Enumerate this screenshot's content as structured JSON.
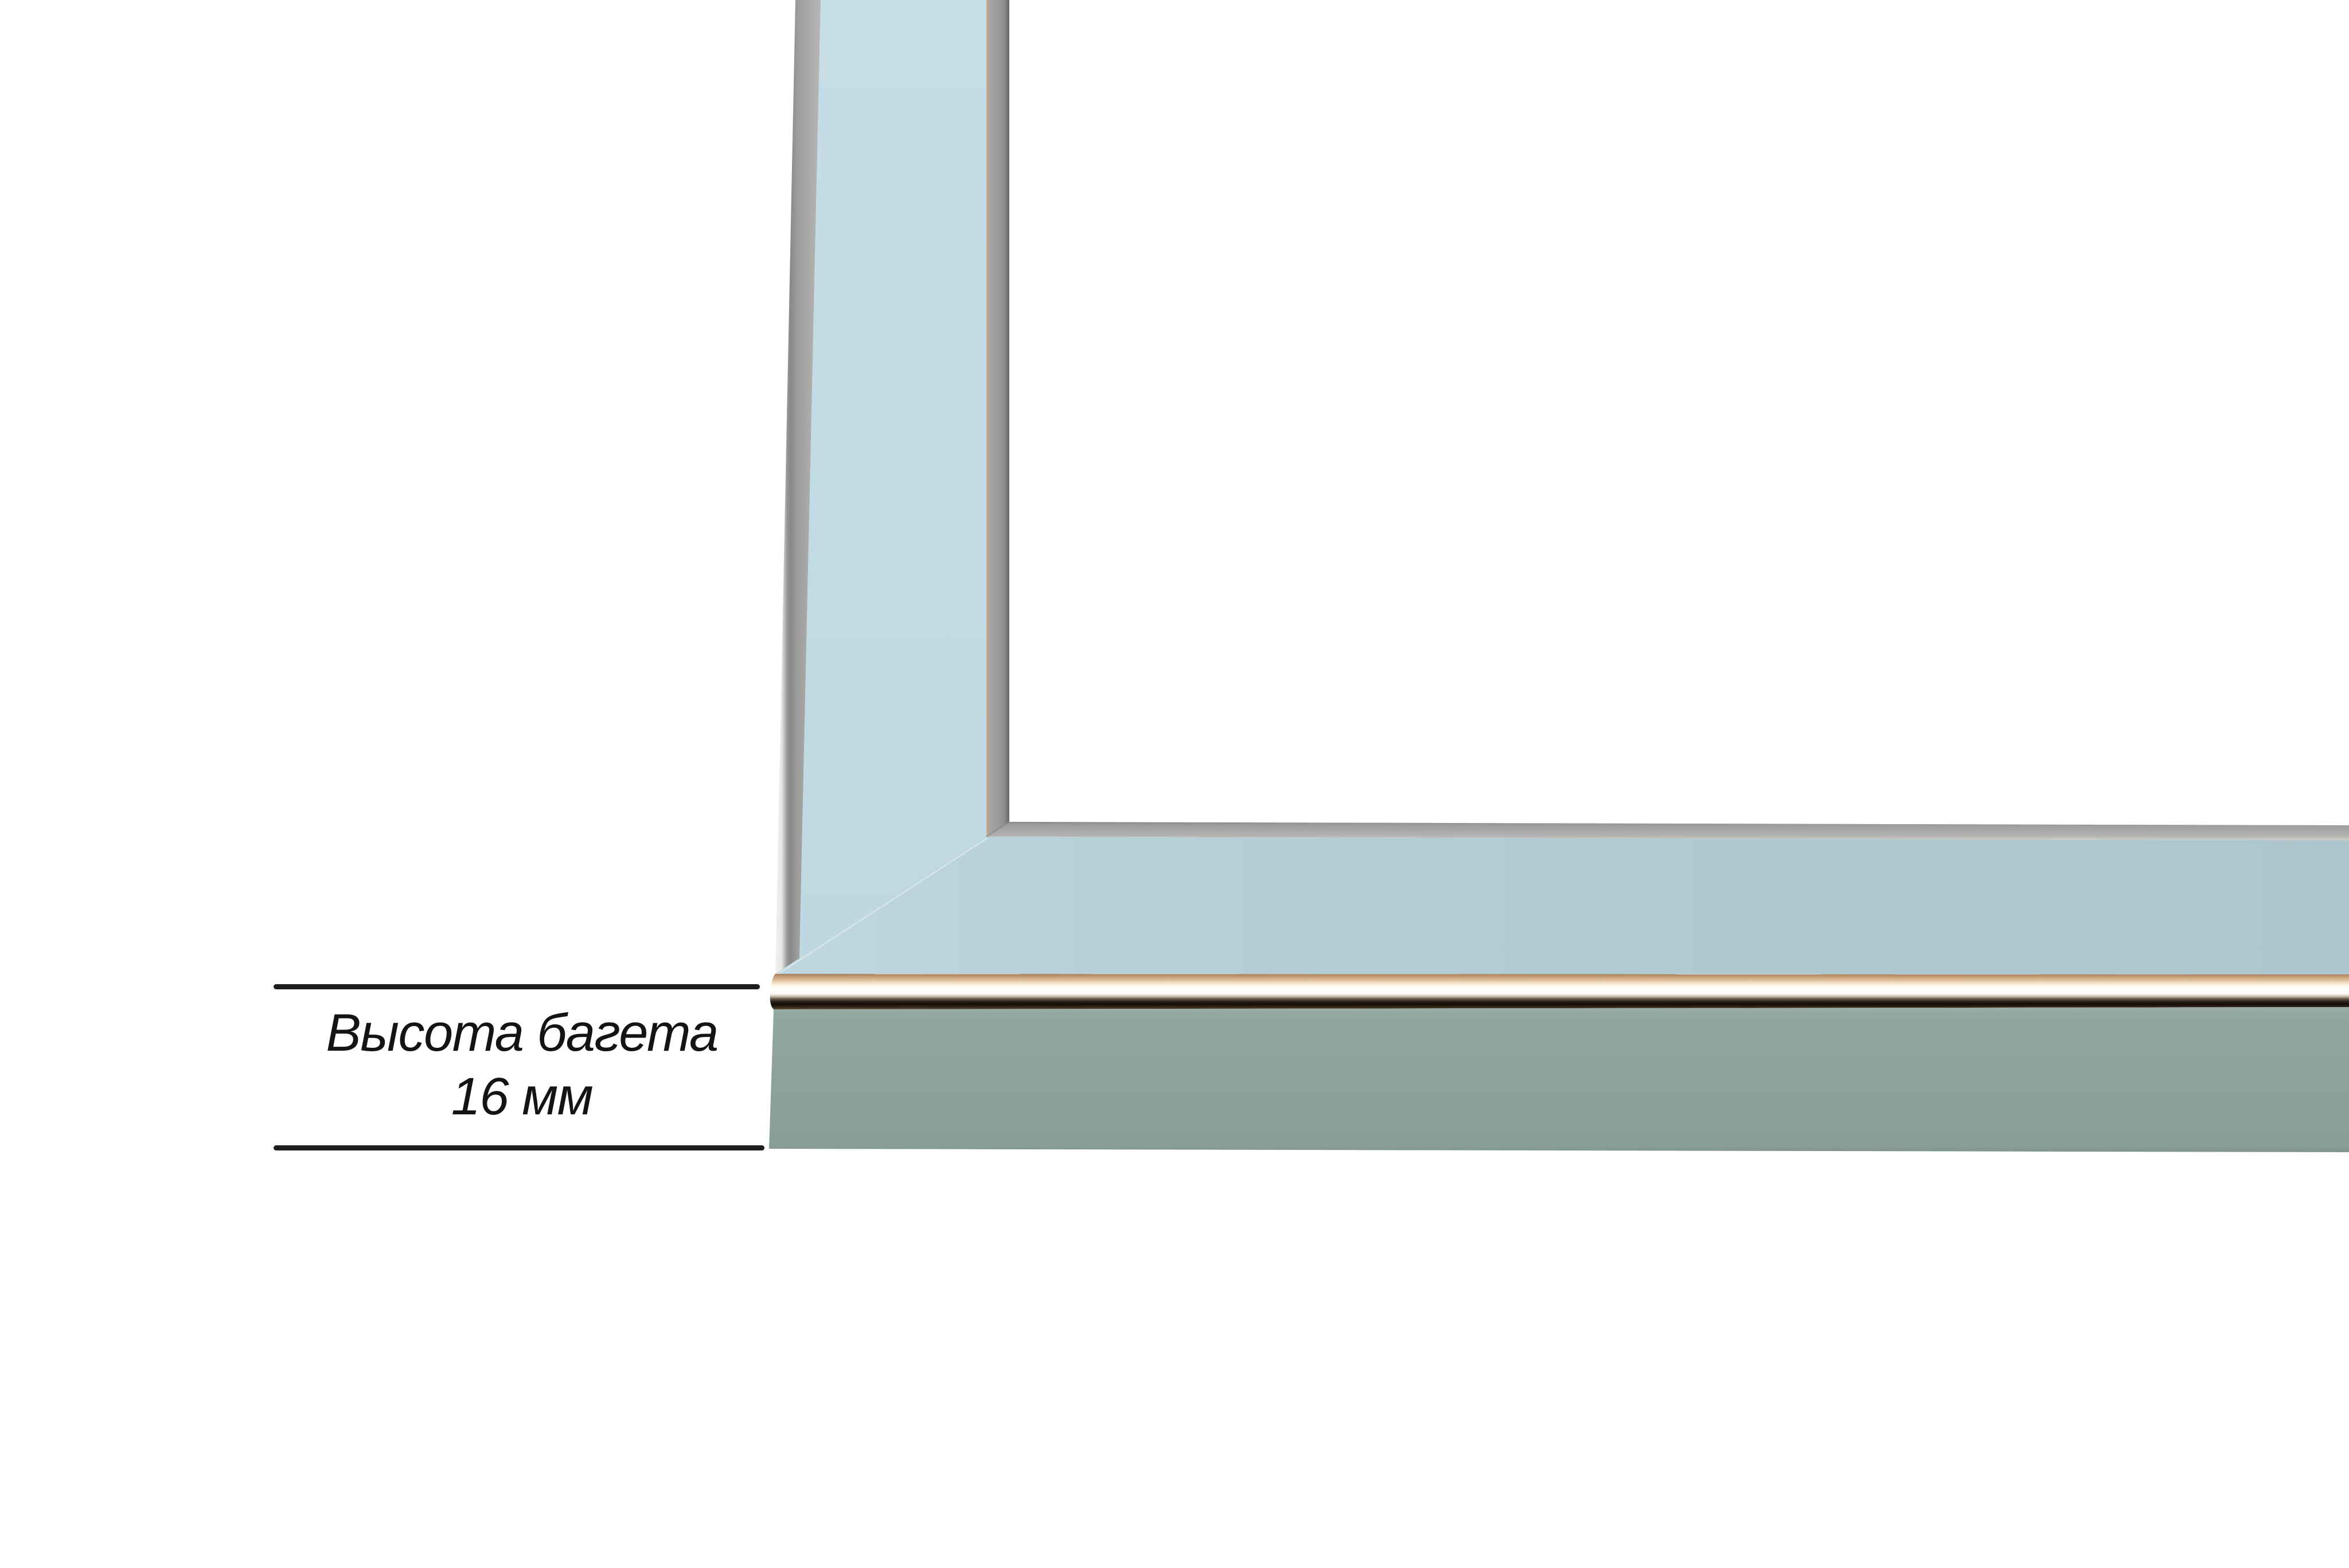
{
  "photo": {
    "kind": "frame-moulding-corner-product-photo",
    "background_color": "#ffffff"
  },
  "annotation": {
    "title_line": "Высота багета",
    "value_line": "16 мм",
    "text_color": "#141414",
    "line_color": "#1d1d1b"
  },
  "frame_colors": {
    "top_face_vertical_bar": "#c3dbe4",
    "top_face_horizontal_bar": "#b2cbd3",
    "side_face": "#8ea39d",
    "silver_edge_strip": "#a3a3a1",
    "chrome_copper_tint": "#c69a70",
    "chrome_highlight": "#ffffff",
    "chrome_dark_line": "#1c140e"
  }
}
